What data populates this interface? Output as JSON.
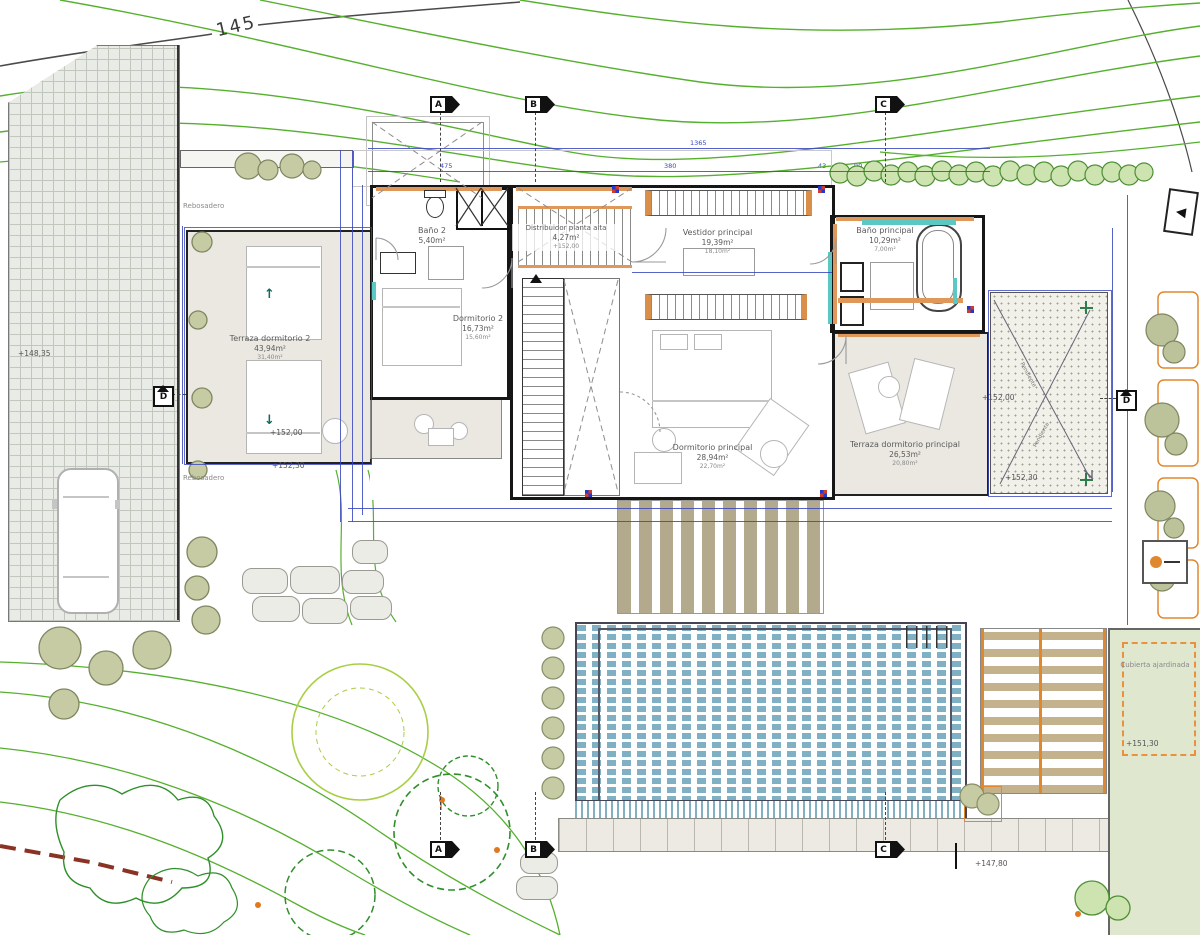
{
  "meta": {
    "title": "Planta alta - plano de arquitectura"
  },
  "colors": {
    "contour_green": "#55b02e",
    "dimension_blue": "#3a46c0",
    "wood_orange": "#e0975a",
    "accent_teal": "#5bc8c4",
    "water_blue": "#7fb0c3",
    "boundary_red": "#8a3324"
  },
  "labels": {
    "contour_level": "145",
    "rebosadero": "Rebosadero",
    "cubierta": "Cubierta ajardinada",
    "pendiente": "Pendiente"
  },
  "rooms": {
    "terraza2": {
      "name": "Terraza dormitorio 2",
      "area": "43,94m²",
      "area_util": "31,40m²"
    },
    "bano2": {
      "name": "Baño 2",
      "area": "5,40m²"
    },
    "distribuidor": {
      "name": "Distribuidor planta alta",
      "area": "4,27m²",
      "elevation": "+152,00"
    },
    "dormitorio2": {
      "name": "Dormitorio 2",
      "area": "16,73m²",
      "area_util": "15,60m²"
    },
    "vestidor": {
      "name": "Vestidor principal",
      "area": "19,39m²",
      "area_util": "18,10m²"
    },
    "bano_principal": {
      "name": "Baño principal",
      "area": "10,29m²",
      "area_util": "7,00m²"
    },
    "dormitorio_principal": {
      "name": "Dormitorio principal",
      "area": "28,94m²",
      "area_util": "22,70m²"
    },
    "terraza_principal": {
      "name": "Terraza dormitorio principal",
      "area": "26,53m²",
      "area_util": "20,80m²"
    }
  },
  "elevations": {
    "paved": "+148,35",
    "terrace_left": "+152,00",
    "terrace_left_edge": "+152,30",
    "gravel_top": "+152,00",
    "gravel_bottom": "+152,30",
    "cubierta": "+151,30",
    "garden": "+147,80"
  },
  "markers": {
    "a": "A",
    "b": "B",
    "c": "C",
    "d": "D"
  },
  "dims": {
    "total": "1365",
    "seg1": "475",
    "seg2": "380",
    "seg3": "43",
    "seg4": "90",
    "w1": "110",
    "w2": "215",
    "w3": "110",
    "w4": "134"
  }
}
